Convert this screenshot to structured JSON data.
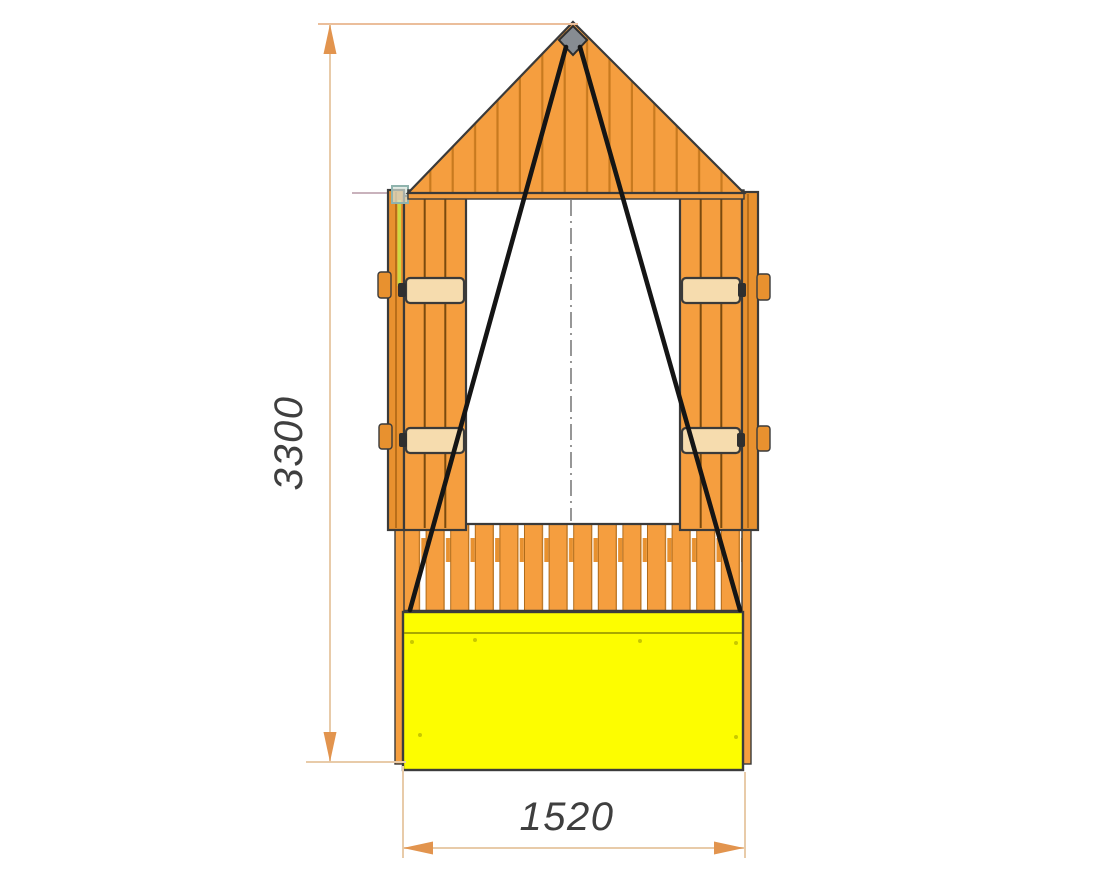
{
  "drawing": {
    "title": "Playhouse front elevation drawing",
    "dimension_height": {
      "value": "3300"
    },
    "dimension_width": {
      "value": "1520"
    },
    "colors": {
      "wood_orange": "#F59E3F",
      "plank_line_brown": "#C87A1F",
      "outline_dark": "#3A3A3A",
      "crossbar_cream": "#F6DCAE",
      "sandbox_yellow": "#FDFD00",
      "rope_black": "#151515",
      "apex_bracket_gray": "#878C92",
      "hinge_bracket_green": "#8FB3AD",
      "edge_strip_yellowgreen": "#CDD842",
      "dimension_line_tan": "#E8CBA9",
      "dimension_arrow_orange": "#E2944E",
      "dimension_text_gray": "#3F3F3F",
      "centerline_gray": "#7D7D7D",
      "background": "#FFFFFF"
    }
  }
}
